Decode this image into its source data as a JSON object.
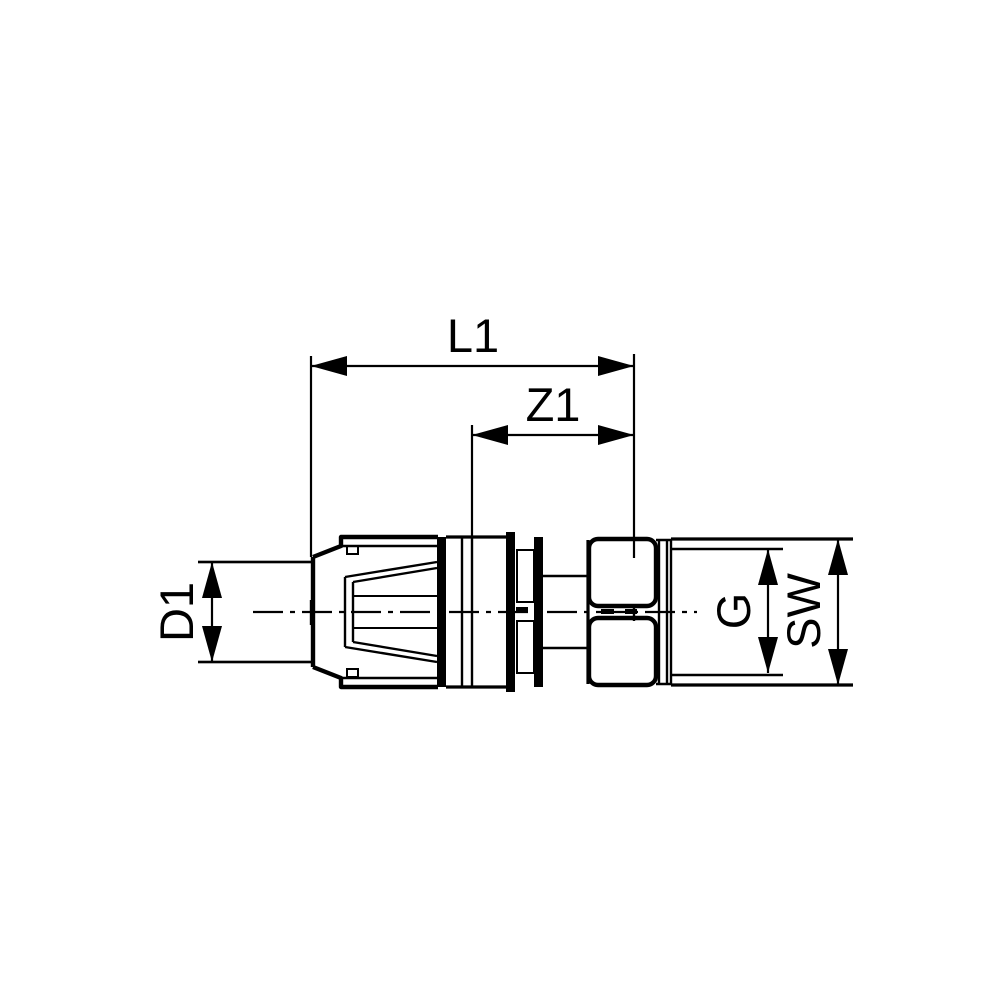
{
  "page": {
    "background": "#ffffff",
    "line_color": "#000000"
  },
  "drawing": {
    "type": "technical-dimension-drawing",
    "labels": {
      "overall_length": "L1",
      "insertion_length": "Z1",
      "pipe_diameter": "D1",
      "thread_size": "G",
      "wrench_size": "SW"
    }
  }
}
